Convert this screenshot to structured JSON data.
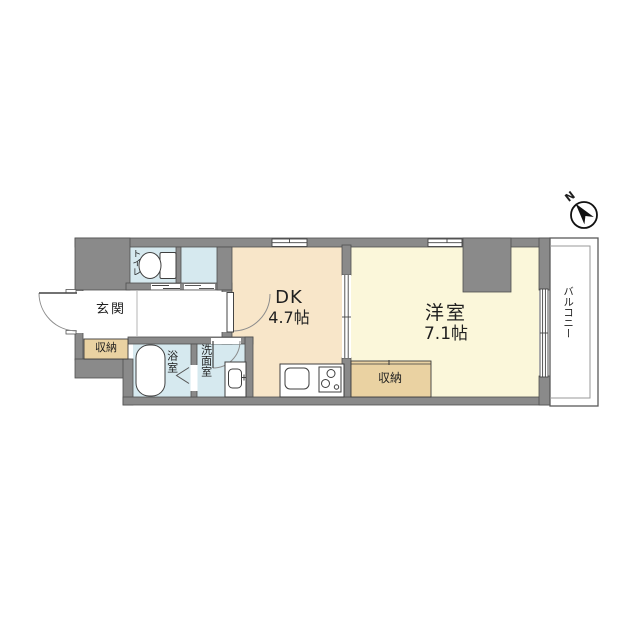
{
  "plan": {
    "compass": {
      "north_label": "N"
    },
    "rooms": {
      "entrance": {
        "label": "玄関"
      },
      "entrance_closet": {
        "label": "収納"
      },
      "toilet": {
        "label": "トイレ"
      },
      "bathroom": {
        "label": "浴室"
      },
      "washroom": {
        "label": "洗面室"
      },
      "dining_kitchen": {
        "label": "DK",
        "size": "4.7帖"
      },
      "western_room": {
        "label": "洋室",
        "size": "7.1帖"
      },
      "room_closet": {
        "label": "収納"
      },
      "balcony": {
        "label": "バルコニー"
      }
    },
    "colors": {
      "wall": "#8a8a8a",
      "dk_floor": "#f8e6c9",
      "western_floor": "#fbf7da",
      "wet_floor": "#d6e9ef",
      "closet_floor": "#ead2a2"
    }
  }
}
